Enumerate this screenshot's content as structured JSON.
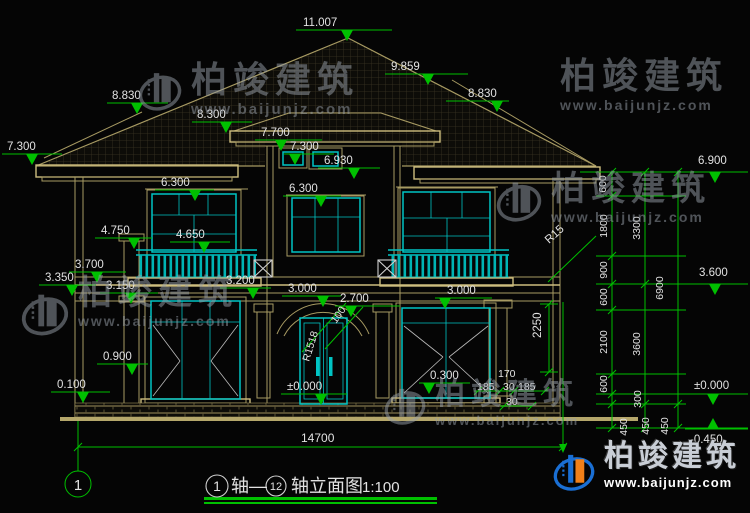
{
  "watermark": {
    "brand": "柏竣建筑",
    "url": "www.baijunjz.com"
  },
  "colors": {
    "background": "#050505",
    "wall_line_tan": "#a79a62",
    "trim_bright_tan": "#cdbd7e",
    "window_cyan": "#00c4c4",
    "dimension_green": "#00c000",
    "label_text": "#e2e2e2",
    "logo_blue": "#1a6fd4",
    "logo_orange": "#f08019"
  },
  "drawing": {
    "sheet_scale": "1:100",
    "overall_width_mm": "14700",
    "axis_bubble": "1"
  },
  "labels": [
    {
      "t": "11.007",
      "x": 303,
      "y": 26,
      "m": [
        296,
        392,
        30,
        347
      ]
    },
    {
      "t": "9.859",
      "x": 391,
      "y": 70,
      "m": [
        385,
        468,
        74,
        428
      ]
    },
    {
      "t": "8.830",
      "x": 112,
      "y": 99,
      "m": [
        107,
        168,
        103,
        137
      ]
    },
    {
      "t": "8.830",
      "x": 468,
      "y": 97,
      "m": [
        446,
        509,
        101,
        497
      ]
    },
    {
      "t": "8.300",
      "x": 197,
      "y": 118,
      "m": [
        192,
        252,
        122,
        226
      ]
    },
    {
      "t": "7.700",
      "x": 261,
      "y": 136,
      "m": [
        255,
        322,
        140,
        281
      ]
    },
    {
      "t": "7.300",
      "x": 7,
      "y": 150,
      "m": [
        2,
        62,
        154,
        32
      ]
    },
    {
      "t": "7.300",
      "x": 290,
      "y": 150,
      "m": [
        284,
        334,
        154,
        295
      ]
    },
    {
      "t": "6.930",
      "x": 324,
      "y": 164,
      "m": [
        318,
        380,
        168,
        354
      ]
    },
    {
      "t": "6.300",
      "x": 161,
      "y": 186,
      "m": [
        155,
        214,
        190,
        195
      ]
    },
    {
      "t": "6.300",
      "x": 289,
      "y": 192,
      "m": [
        283,
        341,
        196,
        321
      ]
    },
    {
      "t": "6.900",
      "x": 698,
      "y": 164,
      "m": [
        688,
        748,
        172,
        715
      ]
    },
    {
      "t": "4.750",
      "x": 101,
      "y": 234,
      "m": [
        95,
        152,
        238,
        134
      ]
    },
    {
      "t": "4.650",
      "x": 176,
      "y": 238,
      "m": [
        170,
        230,
        242,
        204
      ]
    },
    {
      "t": "3.700",
      "x": 75,
      "y": 268,
      "m": [
        69,
        126,
        272,
        97
      ]
    },
    {
      "t": "3.350",
      "x": 45,
      "y": 281,
      "m": [
        39,
        96,
        285,
        72
      ]
    },
    {
      "t": "3.150",
      "x": 106,
      "y": 289,
      "m": [
        100,
        158,
        293,
        131
      ]
    },
    {
      "t": "3.200",
      "x": 226,
      "y": 284,
      "m": [
        220,
        271,
        288,
        253
      ]
    },
    {
      "t": "3.000",
      "x": 288,
      "y": 292,
      "m": [
        282,
        341,
        296,
        323
      ]
    },
    {
      "t": "2.700",
      "x": 340,
      "y": 302,
      "m": [
        335,
        400,
        306,
        351
      ]
    },
    {
      "t": "3.000",
      "x": 447,
      "y": 294,
      "m": [
        435,
        492,
        298,
        445
      ]
    },
    {
      "t": "3.600",
      "x": 699,
      "y": 276,
      "m": [
        688,
        748,
        284,
        715
      ]
    },
    {
      "t": "0.900",
      "x": 103,
      "y": 360,
      "m": [
        97,
        148,
        364,
        132
      ]
    },
    {
      "t": "0.100",
      "x": 57,
      "y": 388,
      "m": [
        51,
        110,
        392,
        83
      ]
    },
    {
      "t": "±0.000",
      "x": 287,
      "y": 390,
      "m": [
        281,
        347,
        394,
        321
      ]
    },
    {
      "t": "0.300",
      "x": 430,
      "y": 379,
      "m": [
        419,
        470,
        383,
        429
      ]
    },
    {
      "t": "±0.000",
      "x": 694,
      "y": 389,
      "m": [
        685,
        748,
        394,
        713
      ]
    },
    {
      "t": "-0.450",
      "x": 690,
      "y": 443,
      "m": [
        685,
        748,
        429,
        713
      ],
      "dir": "up"
    },
    {
      "t": "14700",
      "x": 301,
      "y": 442,
      "fs": 12
    },
    {
      "t": "2250",
      "x": 541,
      "y": 338,
      "r": -90
    },
    {
      "t": "170",
      "x": 498,
      "y": 377,
      "fs": 10.5
    },
    {
      "t": "185",
      "x": 477,
      "y": 390,
      "fs": 10.5
    },
    {
      "t": "30",
      "x": 503,
      "y": 390,
      "fs": 10.5
    },
    {
      "t": "185",
      "x": 518,
      "y": 390,
      "fs": 10.5
    },
    {
      "t": "30",
      "x": 506,
      "y": 405,
      "fs": 10.5
    },
    {
      "t": "R15",
      "x": 549,
      "y": 244,
      "r": -42
    },
    {
      "t": "R1518",
      "x": 309,
      "y": 362,
      "r": -73,
      "fs": 10.5
    },
    {
      "t": "100",
      "x": 336,
      "y": 324,
      "r": -55,
      "fs": 10.5
    },
    {
      "t": "600",
      "x": 606,
      "y": 184,
      "r": -90,
      "a": "m",
      "fs": 10.5
    },
    {
      "t": "1800",
      "x": 607,
      "y": 226,
      "r": -90,
      "a": "m",
      "fs": 10.5
    },
    {
      "t": "900",
      "x": 607,
      "y": 270,
      "r": -90,
      "a": "m",
      "fs": 10.5
    },
    {
      "t": "600",
      "x": 607,
      "y": 297,
      "r": -90,
      "a": "m",
      "fs": 10.5
    },
    {
      "t": "2100",
      "x": 607,
      "y": 342,
      "r": -90,
      "a": "m",
      "fs": 10.5
    },
    {
      "t": "600",
      "x": 607,
      "y": 384,
      "r": -90,
      "a": "m",
      "fs": 10.5
    },
    {
      "t": "300",
      "x": 641,
      "y": 399,
      "r": -90,
      "a": "m",
      "fs": 10.5
    },
    {
      "t": "450",
      "x": 627,
      "y": 427,
      "r": -90,
      "a": "m",
      "fs": 10.5
    },
    {
      "t": "3300",
      "x": 640,
      "y": 228,
      "r": -90,
      "a": "m",
      "fs": 10.5
    },
    {
      "t": "3600",
      "x": 640,
      "y": 344,
      "r": -90,
      "a": "m",
      "fs": 10.5
    },
    {
      "t": "450",
      "x": 649,
      "y": 426,
      "r": -90,
      "a": "m",
      "fs": 10.5
    },
    {
      "t": "6900",
      "x": 663,
      "y": 288,
      "r": -90,
      "a": "m",
      "fs": 10.5
    },
    {
      "t": "450",
      "x": 668,
      "y": 426,
      "r": -90,
      "a": "m",
      "fs": 10.5
    },
    {
      "t": "1",
      "x": 217,
      "y": 491,
      "a": "m",
      "fs": 14,
      "n": "title-axis-start"
    },
    {
      "t": "轴—",
      "x": 231,
      "y": 492,
      "fs": 18,
      "n": "title-text"
    },
    {
      "t": "12",
      "x": 276,
      "y": 490,
      "a": "m",
      "fs": 11,
      "n": "title-axis-end"
    },
    {
      "t": "轴立面图",
      "x": 291,
      "y": 492,
      "fs": 18,
      "n": "title-name"
    },
    {
      "t": "1:100",
      "x": 362,
      "y": 492,
      "fs": 15,
      "n": "title-scale"
    },
    {
      "t": "1",
      "x": 78,
      "y": 490,
      "a": "m",
      "fs": 15,
      "n": "axis-bubble-number"
    }
  ]
}
